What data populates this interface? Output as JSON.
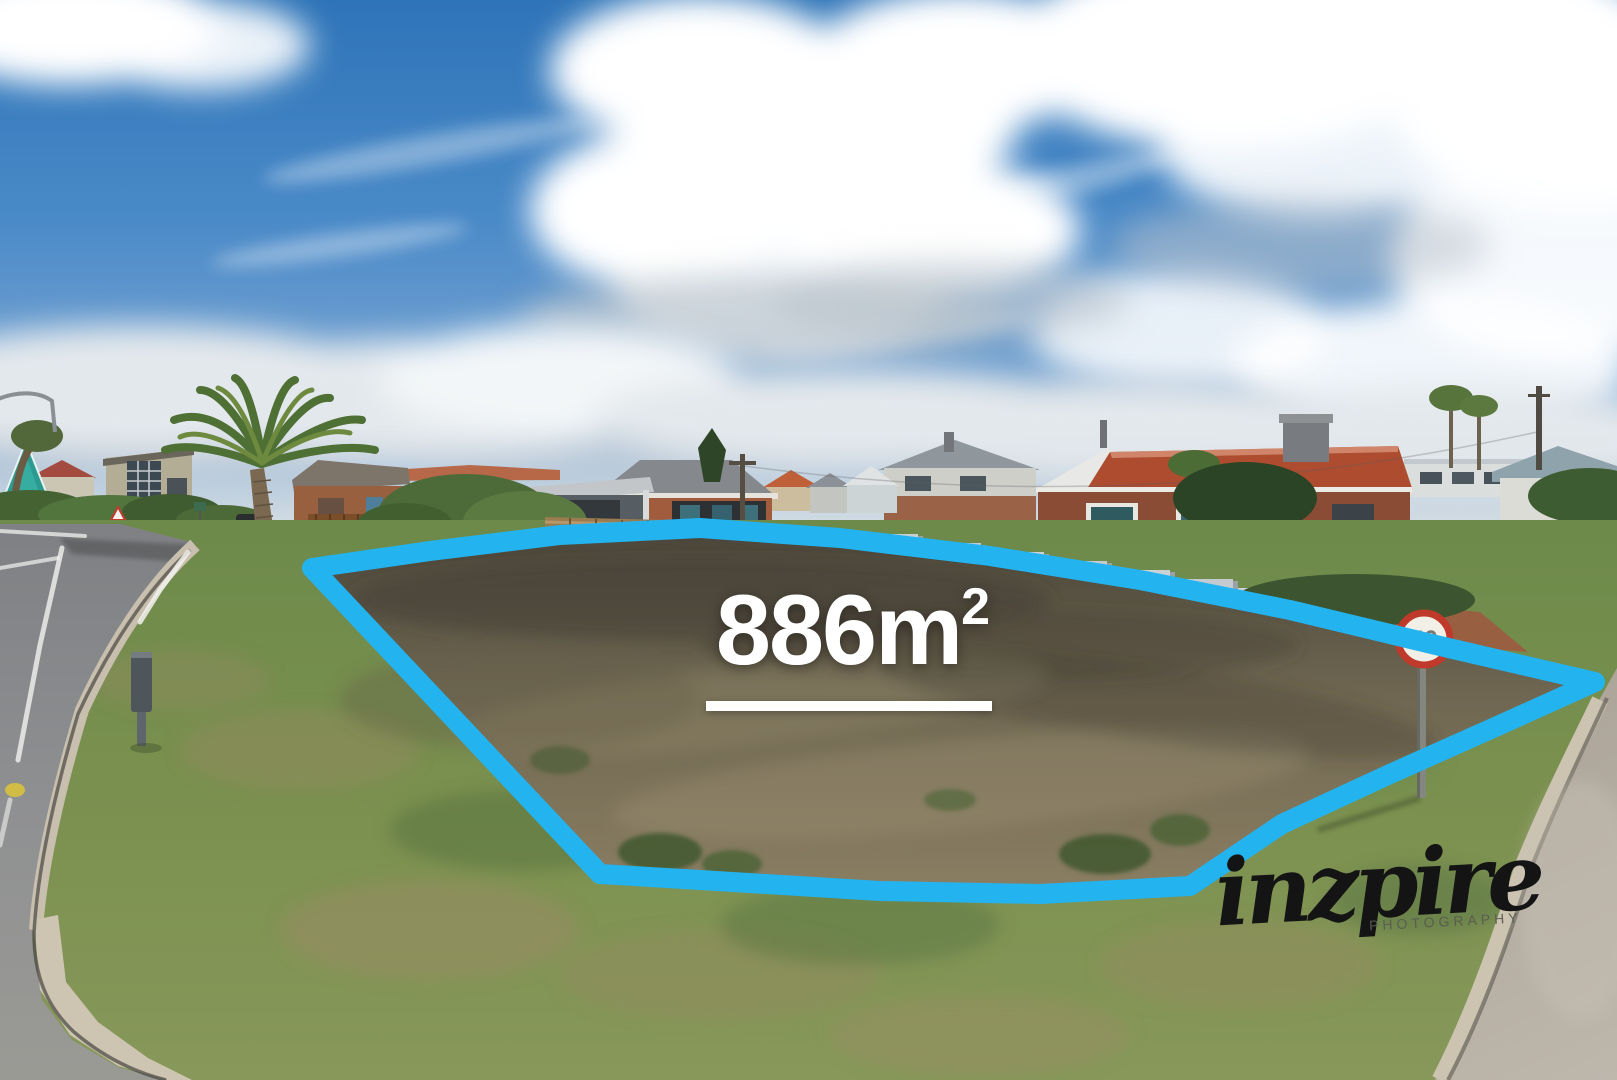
{
  "overlay": {
    "area_value": "886m",
    "area_superscript": "2",
    "boundary_color": "#23b4f0"
  },
  "watermark": {
    "brand": "inzpire",
    "subtitle": "PHOTOGRAPHY"
  },
  "road_sign": {
    "speed_limit": "40"
  },
  "colors": {
    "sky_top": "#2e74b8",
    "label_text": "#ffffff",
    "watermark_ink": "#141414",
    "sign_ring": "#bf3a2b",
    "dry_grass": "#7d7257",
    "verge_green": "#7c9150"
  }
}
